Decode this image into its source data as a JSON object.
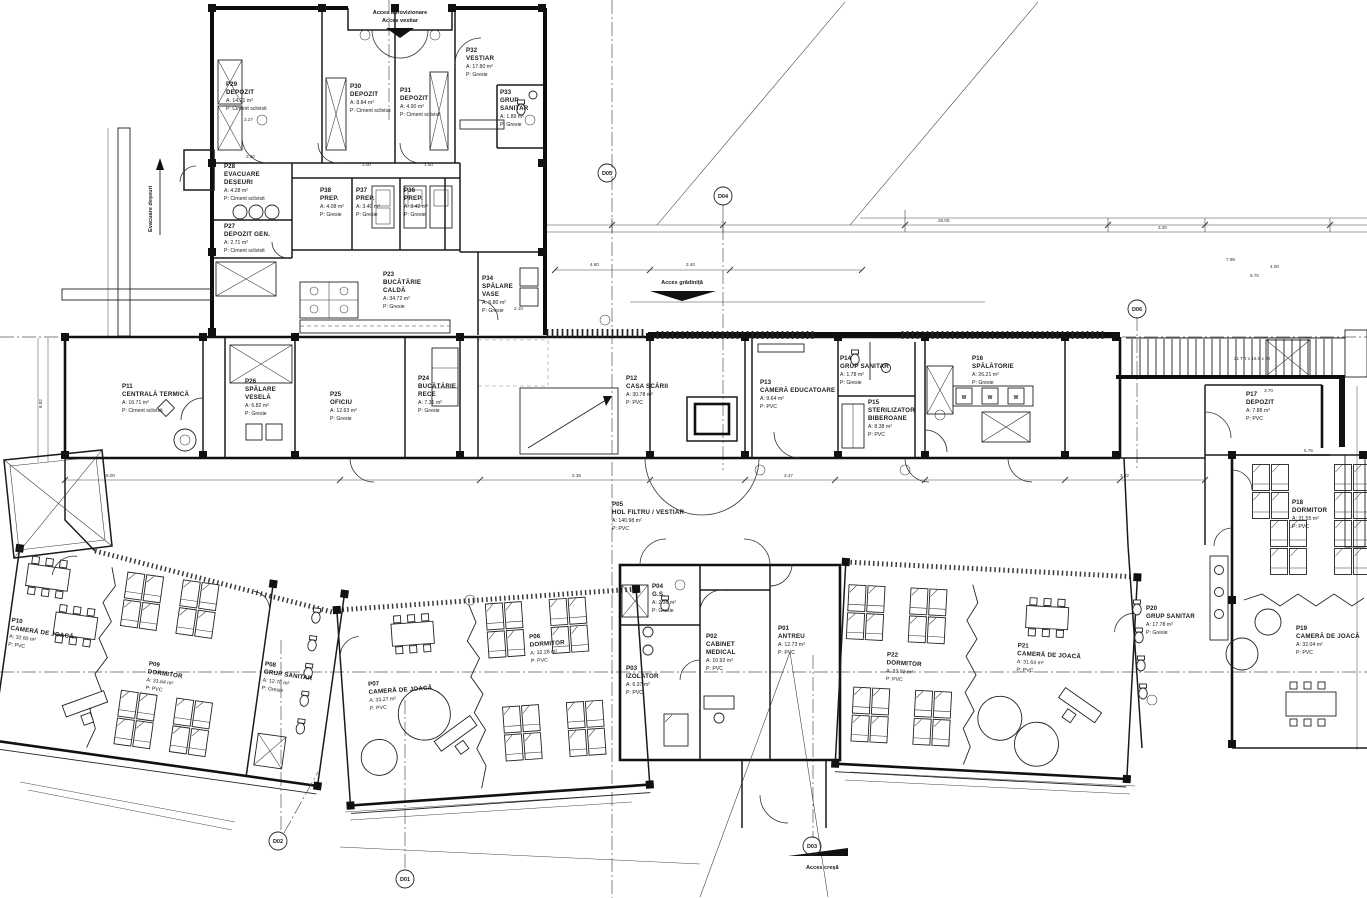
{
  "plan": {
    "rooms": [
      {
        "id": "P01",
        "name": "ANTREU",
        "area": "A: 12.73 m²",
        "floor": "P: PVC"
      },
      {
        "id": "P02",
        "name": "CABINET",
        "name2": "MEDICAL",
        "area": "A: 10.92 m²",
        "floor": "P: PVC"
      },
      {
        "id": "P03",
        "name": "IZOLATOR",
        "area": "A: 6.37 m²",
        "floor": "P: PVC"
      },
      {
        "id": "P04",
        "name": "G.S.",
        "area": "A: 2.36 m²",
        "floor": "P: Gresie"
      },
      {
        "id": "P05",
        "name": "HOL FILTRU / VESTIAR",
        "area": "A: 140.98 m²",
        "floor": "P: PVC"
      },
      {
        "id": "P06",
        "name": "DORMITOR",
        "area": "A: 32.28 m²",
        "floor": "P: PVC"
      },
      {
        "id": "P07",
        "name": "CAMERĂ DE JOACĂ",
        "area": "A: 33.27 m²",
        "floor": "P: PVC"
      },
      {
        "id": "P08",
        "name": "GRUP SANITAR",
        "area": "A: 12.78 m²",
        "floor": "P: Gresie"
      },
      {
        "id": "P09",
        "name": "DORMITOR",
        "area": "A: 31.64 m²",
        "floor": "P: PVC"
      },
      {
        "id": "P10",
        "name": "CAMERĂ DE JOACĂ",
        "area": "A: 32.60 m²",
        "floor": "P: PVC"
      },
      {
        "id": "P11",
        "name": "CENTRALĂ TERMICĂ",
        "area": "A: 16.71 m²",
        "floor": "P: Ciment sclivisit"
      },
      {
        "id": "P12",
        "name": "CASA SCĂRII",
        "area": "A: 30.78 m²",
        "floor": "P: PVC"
      },
      {
        "id": "P13",
        "name": "CAMERĂ EDUCATOARE",
        "area": "A: 9.64 m²",
        "floor": "P: PVC"
      },
      {
        "id": "P14",
        "name": "GRUP SANITAR",
        "area": "A: 1.78 m²",
        "floor": "P: Gresie"
      },
      {
        "id": "P15",
        "name": "STERILIZATOR",
        "name2": "BIBEROANE",
        "area": "A: 8.38 m²",
        "floor": "P: PVC"
      },
      {
        "id": "P16",
        "name": "SPĂLĂTORIE",
        "area": "A: 26.21 m²",
        "floor": "P: Gresie"
      },
      {
        "id": "P17",
        "name": "DEPOZIT",
        "area": "A: 7.88 m²",
        "floor": "P: PVC"
      },
      {
        "id": "P18",
        "name": "DORMITOR",
        "area": "A: 31.55 m²",
        "floor": "P: PVC"
      },
      {
        "id": "P19",
        "name": "CAMERĂ DE JOACĂ",
        "area": "A: 32.04 m²",
        "floor": "P: PVC"
      },
      {
        "id": "P20",
        "name": "GRUP SANITAR",
        "area": "A: 17.78 m²",
        "floor": "P: Gresie"
      },
      {
        "id": "P21",
        "name": "CAMERĂ DE JOACĂ",
        "area": "A: 31.64 m²",
        "floor": "P: PVC"
      },
      {
        "id": "P22",
        "name": "DORMITOR",
        "area": "A: 33.92 m²",
        "floor": "P: PVC"
      },
      {
        "id": "P23",
        "name": "BUCĂTĂRIE",
        "name2": "CALDĂ",
        "area": "A: 34.72 m²",
        "floor": "P: Gresie"
      },
      {
        "id": "P24",
        "name": "BUCĂTĂRIE",
        "name2": "RECE",
        "area": "A: 7.31 m²",
        "floor": "P: Gresie"
      },
      {
        "id": "P25",
        "name": "OFICIU",
        "area": "A: 12.63 m²",
        "floor": "P: Gresie"
      },
      {
        "id": "P26",
        "name": "SPĂLARE",
        "name2": "VESELĂ",
        "area": "A: 6.82 m²",
        "floor": "P: Gresie"
      },
      {
        "id": "P27",
        "name": "DEPOZIT GEN.",
        "area": "A: 2.71 m²",
        "floor": "P: Ciment sclivisit"
      },
      {
        "id": "P28",
        "name": "EVACUARE",
        "name2": "DEȘEURI",
        "area": "A: 4.28 m²",
        "floor": "P: Ciment sclivisit"
      },
      {
        "id": "P29",
        "name": "DEPOZIT",
        "area": "A: 14.21 m²",
        "floor": "P: Ciment sclivisit"
      },
      {
        "id": "P30",
        "name": "DEPOZIT",
        "area": "A: 8.84 m²",
        "floor": "P: Ciment sclivisit"
      },
      {
        "id": "P31",
        "name": "DEPOZIT",
        "area": "A: 4.90 m²",
        "floor": "P: Ciment sclivisit"
      },
      {
        "id": "P32",
        "name": "VESTIAR",
        "area": "A: 17.80 m²",
        "floor": "P: Gresie"
      },
      {
        "id": "P33",
        "name": "GRUP",
        "name2": "SANITAR",
        "area": "A: 1.89 m²",
        "floor": "P: Gresie"
      },
      {
        "id": "P34",
        "name": "SPĂLARE",
        "name2": "VASE",
        "area": "A: 6.80 m²",
        "floor": "P: Gresie"
      },
      {
        "id": "P36",
        "name": "PREP.",
        "area": "A: 3.42 m²",
        "floor": "P: Gresie"
      },
      {
        "id": "P37",
        "name": "PREP.",
        "area": "A: 3.40 m²",
        "floor": "P: Gresie"
      },
      {
        "id": "P38",
        "name": "PREP.",
        "area": "A: 4.08 m²",
        "floor": "P: Gresie"
      }
    ],
    "annotations": {
      "acces_aprovizionare": "Acces aprovizionare",
      "acces_vestiar": "Acces vestiar",
      "evacuare_deseuri": "Evacuare deșeuri",
      "acces_gradinita": "Acces grădiniță",
      "acces_cresa": "Acces creșă",
      "stair_note": "21 TR x 16.5 x 28",
      "washer": "W"
    },
    "markers": {
      "d01": "D01",
      "d02": "D02",
      "d03": "D03",
      "d04": "D04",
      "d05": "D05",
      "d06": "D06"
    },
    "dims": {
      "d1": "28.05",
      "d2": "7.98",
      "d3": "4.00",
      "d4": "8.70",
      "d5": "4.80",
      "d6": "2.40",
      "d7": "8.48",
      "d8": "8.00",
      "d9": "2.38",
      "d10": "3.47",
      "d11": "3.32",
      "d12": "6.75",
      "d13": "6.82",
      "d14": "3.70",
      "d15": "2.27",
      "d16": "3.30",
      "d17": "1.50",
      "d18": "2.10",
      "d19": "1.00",
      "d20": "3.20"
    }
  }
}
